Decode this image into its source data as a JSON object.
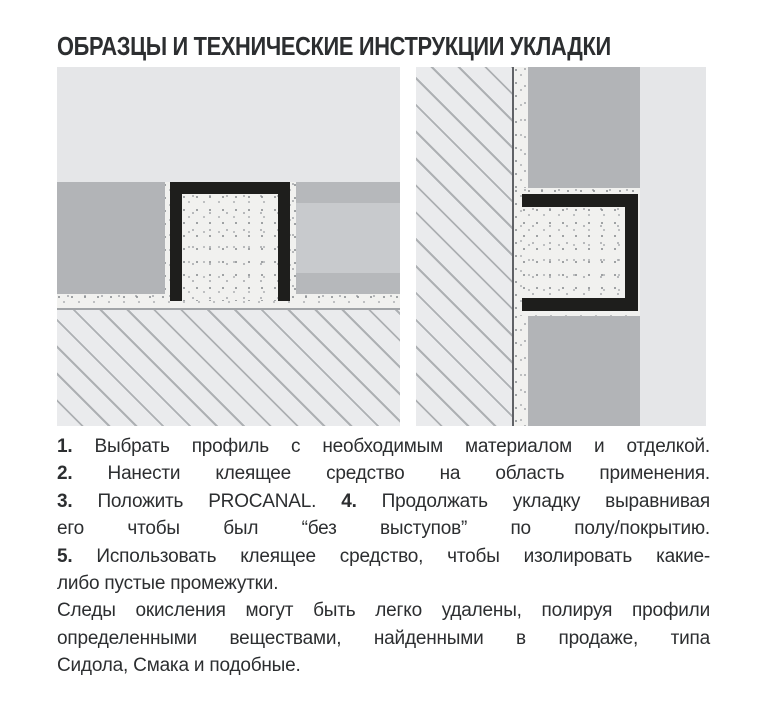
{
  "title": "ОБРАЗЦЫ И ТЕХНИЧЕСКИЕ ИНСТРУКЦИИ УКЛАДКИ",
  "instructions": {
    "lines": [
      {
        "justify": true,
        "segments": [
          {
            "text": "1.",
            "bold": true
          },
          {
            "text": " Выбрать профиль с необходимым материалом и отделкой.",
            "bold": false
          }
        ]
      },
      {
        "justify": true,
        "segments": [
          {
            "text": "2.",
            "bold": true
          },
          {
            "text": " Нанести клеящее средство на область применения.",
            "bold": false
          }
        ]
      },
      {
        "justify": true,
        "segments": [
          {
            "text": "3.",
            "bold": true
          },
          {
            "text": " Положить PROCANAL. ",
            "bold": false
          },
          {
            "text": "4.",
            "bold": true
          },
          {
            "text": " Продолжать укладку выравнивая",
            "bold": false
          }
        ]
      },
      {
        "justify": true,
        "segments": [
          {
            "text": "его чтобы был “без выступов” по полу/покрытию.",
            "bold": false
          }
        ]
      },
      {
        "justify": true,
        "segments": [
          {
            "text": "5.",
            "bold": true
          },
          {
            "text": " Использовать клеящее средство, чтобы изолировать какие-",
            "bold": false
          }
        ]
      },
      {
        "justify": false,
        "segments": [
          {
            "text": "либо пустые промежутки.",
            "bold": false
          }
        ]
      },
      {
        "justify": true,
        "segments": [
          {
            "text": "Следы окисления могут быть легко удалены, полируя профили",
            "bold": false
          }
        ]
      },
      {
        "justify": true,
        "segments": [
          {
            "text": "определенными веществами, найденными в продаже, типа",
            "bold": false
          }
        ]
      },
      {
        "justify": false,
        "segments": [
          {
            "text": "Сидола, Смака и подобные.",
            "bold": false
          }
        ]
      }
    ]
  },
  "colors": {
    "text": "#2c2e30",
    "profile-black": "#1e1e1c",
    "tile-gray": "#b2b4b7",
    "tile-light": "#c8cacd",
    "tile-band": "#b6b8bb",
    "background-gray": "#e5e6e8",
    "hatch-bg": "#eaebed",
    "hatch-line": "#adb0b3",
    "stipple-bg": "#f1f1ef",
    "stipple-dot": "#8f9295",
    "wall-line": "#606266",
    "screed-line": "#a2a5a8"
  }
}
